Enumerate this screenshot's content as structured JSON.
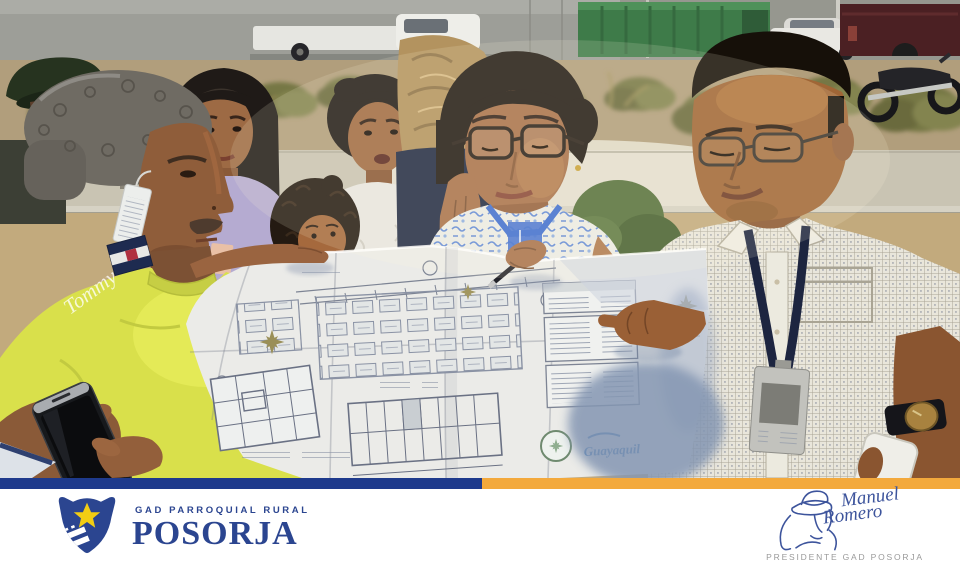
{
  "footer": {
    "stripe": {
      "blue": "#1e3a8c",
      "yellow": "#f3a93c"
    },
    "brand": {
      "tagline": "GAD PARROQUIAL RURAL",
      "name": "POSORJA",
      "text_color": "#2b4590",
      "star_color": "#f2cd13",
      "shield_color": "#2b4590"
    },
    "signature": {
      "name_line1": "Manuel",
      "name_line2": "Romero",
      "title": "PRESIDENTE GAD POSORJA",
      "ink_color": "#3d549c",
      "title_color": "#9a9a9a"
    }
  },
  "photo": {
    "tshirt_logo_text": "Tommy",
    "blueprint_logo_text": "Guayaquil"
  }
}
